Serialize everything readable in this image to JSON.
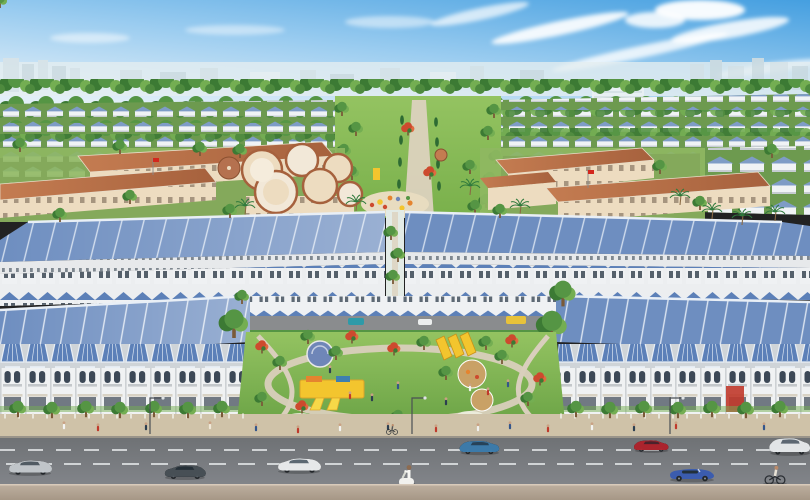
{
  "scene": {
    "name": "aerial-render-residential-township",
    "setting": "aerial 3D architectural rendering of a residential township",
    "regions": [
      "sky",
      "city-skyline",
      "tree-belt",
      "villa-rows",
      "school-campus",
      "kindergarten-round-buildings",
      "central-green-axis",
      "shophouse-rows",
      "playground-park",
      "tree-lined-sidewalk",
      "boulevard",
      "median-strip"
    ],
    "park_features": [
      "yellow-slides",
      "play-structures",
      "round-plazas",
      "flowering-trees",
      "walking-paths",
      "lawn"
    ]
  },
  "colors": {
    "sky_top": "#459fe0",
    "sky_mid": "#9ccdf0",
    "sky_horizon": "#e2eff8",
    "cloud": "#ffffff",
    "skyline": "#dde8ec",
    "tree_dark": "#3c7a34",
    "tree_mid": "#559544",
    "tree_light": "#74ae52",
    "palm_green": "#2f7a3c",
    "lawn_light": "#94c361",
    "lawn": "#79b04b",
    "lawn_deep": "#68a144",
    "villa_roof": "#7e9cc6",
    "slab_roof": "#6e8ec0",
    "slab_ridge": "#e9eff6",
    "gable_roof": "#5c80b8",
    "house_wall": "#f0f2f3",
    "window_dark": "#3a4754",
    "school_roof": "#a6613d",
    "school_roof_light": "#c47c51",
    "school_wall": "#eddcc0",
    "flag_red": "#d3271d",
    "path": "#d9cfbc",
    "plaza_tan": "#c9a166",
    "plaza_blue": "#6f86b8",
    "play_yellow": "#f3c52e",
    "play_orange": "#e5842f",
    "flower_red": "#cd4a2e",
    "sidewalk": "#cfc2a8",
    "road": "#6e7174",
    "road_light": "#82858a",
    "lane_mark": "#eef1f2",
    "median": "#beb0a0",
    "median_dark": "#a69786",
    "storefront_red": "#c0392b"
  },
  "traffic": {
    "cars": [
      {
        "name": "silver-sedan",
        "color": "#c8cdd1"
      },
      {
        "name": "dark-gray-sedan",
        "color": "#4a5258"
      },
      {
        "name": "white-sports-car",
        "color": "#edeff1"
      },
      {
        "name": "blue-hatchback",
        "color": "#3e7fb0"
      },
      {
        "name": "red-sedan",
        "color": "#b2252f"
      },
      {
        "name": "white-suv",
        "color": "#e9ecee"
      },
      {
        "name": "blue-convertible",
        "color": "#3b5cae"
      }
    ],
    "riders": [
      {
        "name": "scooter-rider",
        "color": "#f1f1ee"
      },
      {
        "name": "cyclist-near-curb",
        "color": "#e8e2d6"
      },
      {
        "name": "cyclist-far-lane",
        "color": "#555555"
      }
    ],
    "street_cars": [
      {
        "name": "teal-car",
        "color": "#2e9aa8"
      },
      {
        "name": "white-car",
        "color": "#eceeee"
      },
      {
        "name": "yellow-shuttle",
        "color": "#e8c23a"
      }
    ]
  }
}
